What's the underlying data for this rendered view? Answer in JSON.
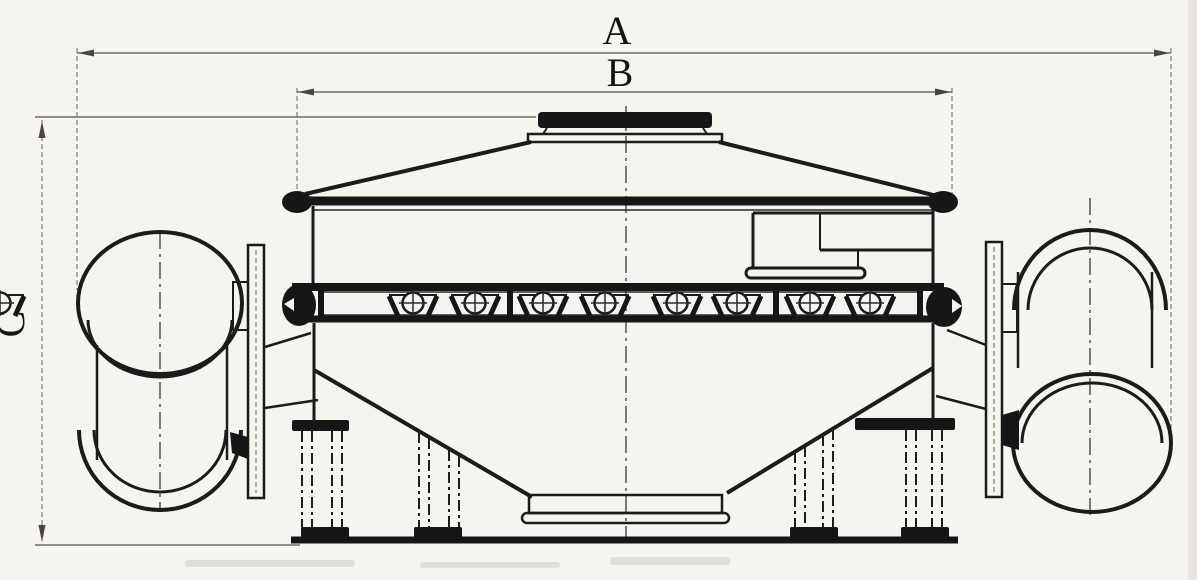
{
  "drawing": {
    "type": "engineering-dimension-drawing",
    "dimension_labels": {
      "a": "A",
      "b": "B",
      "c": "C"
    }
  },
  "colors": {
    "background": "#f6f4ef",
    "machine_line": "#1b1b1b",
    "dimension_line": "#55504a",
    "label_text": "#141414"
  }
}
